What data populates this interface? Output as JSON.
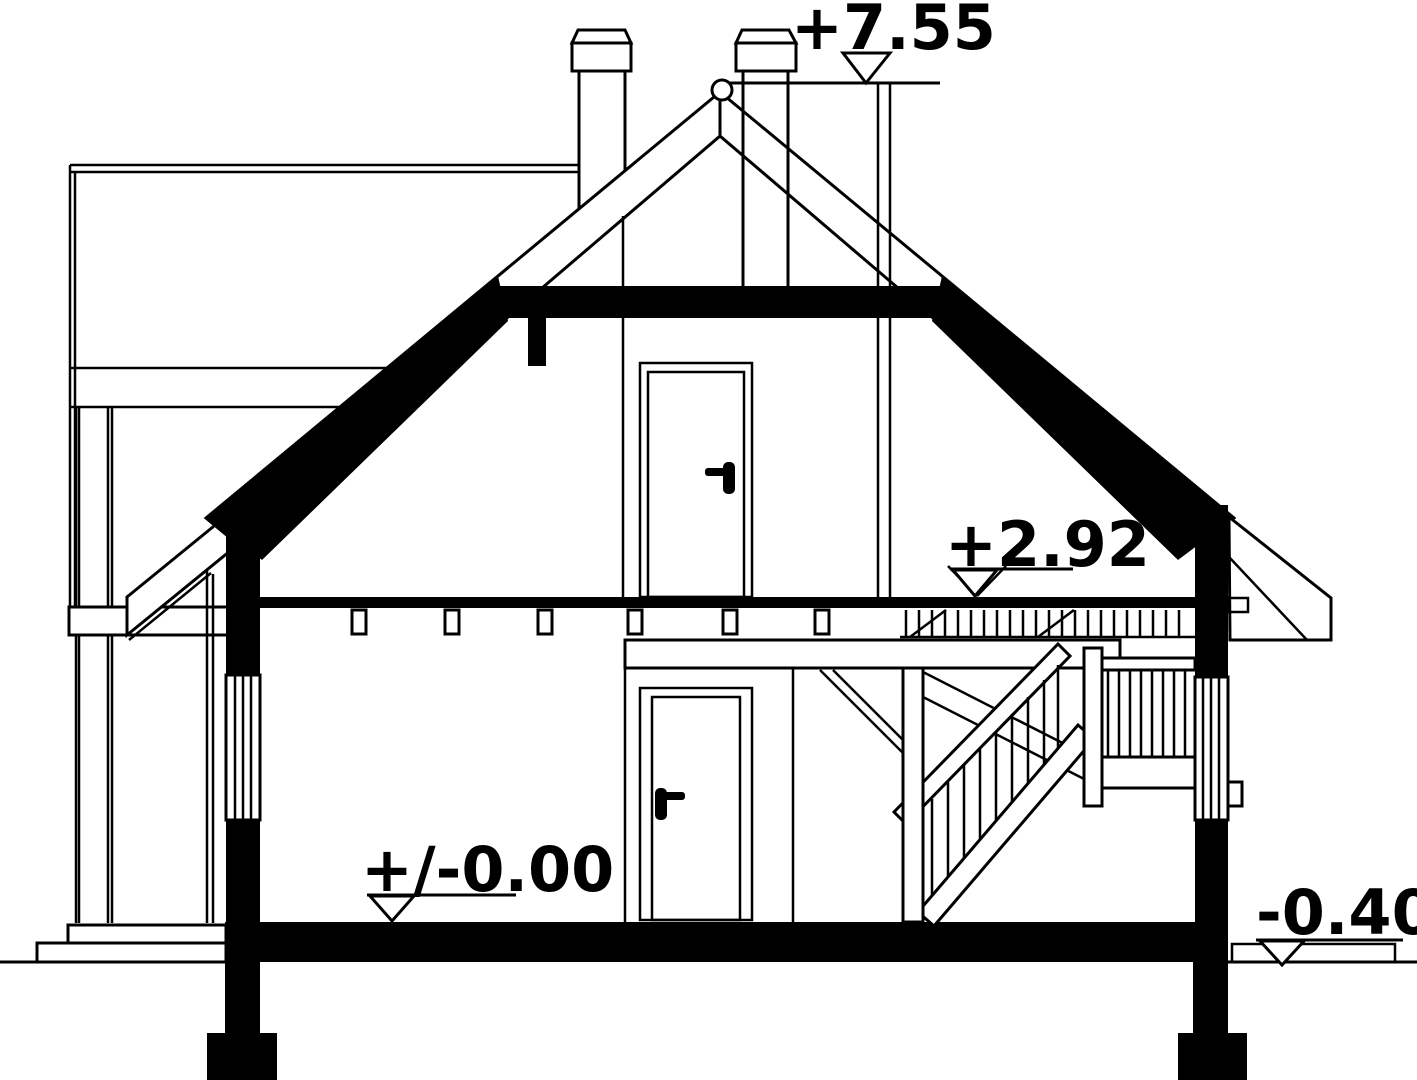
{
  "drawing": {
    "kind": "house cross-section",
    "colors": {
      "ink": "#000000",
      "paper": "#ffffff"
    }
  },
  "elevation_markers": {
    "ridge": {
      "label": "+7.55"
    },
    "attic_floor": {
      "label": "+2.92"
    },
    "ground_floor": {
      "label": "+/-0.00"
    },
    "site_grade": {
      "label": "-0.40"
    }
  }
}
